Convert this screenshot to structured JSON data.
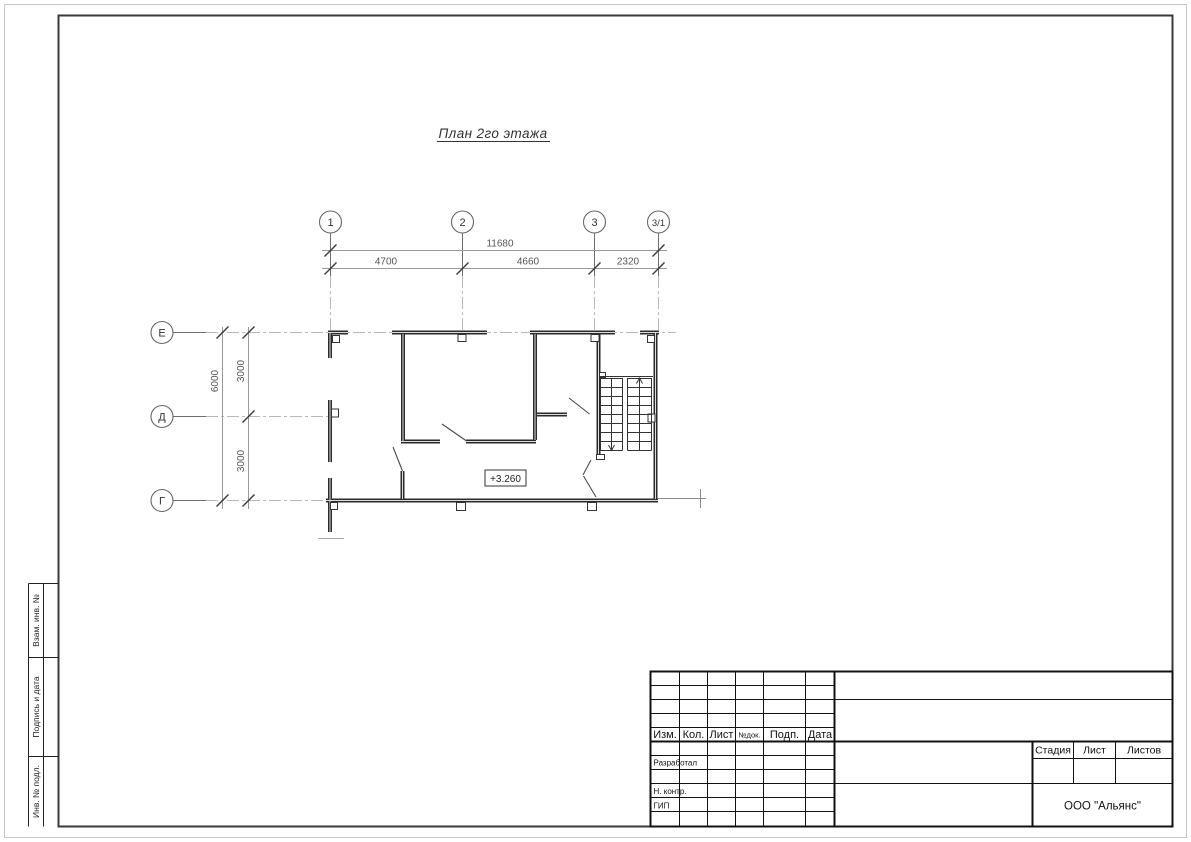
{
  "page": {
    "title": "План 2го этажа"
  },
  "plan": {
    "elevation": "+3.260",
    "axes_top": [
      "1",
      "2",
      "3",
      "3/1"
    ],
    "axes_left": [
      "Е",
      "Д",
      "Г"
    ],
    "dim_total_width": "11680",
    "dim_spans": [
      "4700",
      "4660",
      "2320"
    ],
    "dim_total_height": "6000",
    "dim_vspans": [
      "3000",
      "3000"
    ]
  },
  "side_strip": {
    "labels": [
      "Взам. инв. №",
      "Подпись и дата",
      "Инв. № подл."
    ]
  },
  "title_block": {
    "rev_headers": [
      "Изм.",
      "Кол.",
      "Лист",
      "№док.",
      "Подп.",
      "Дата"
    ],
    "roles": [
      "Разработал",
      "Н. контр.",
      "ГИП"
    ],
    "stage_header": "Стадия",
    "sheet_header": "Лист",
    "sheets_header": "Листов",
    "company": "ООО \"Альянс\""
  }
}
